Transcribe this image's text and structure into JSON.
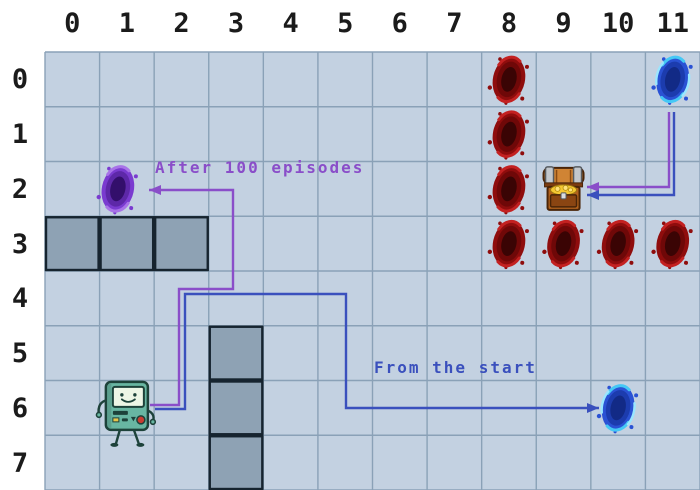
{
  "figure": {
    "type": "gridworld-diagram",
    "cols": 12,
    "rows": 8,
    "col_labels": [
      "0",
      "1",
      "2",
      "3",
      "4",
      "5",
      "6",
      "7",
      "8",
      "9",
      "10",
      "11"
    ],
    "row_labels": [
      "0",
      "1",
      "2",
      "3",
      "4",
      "5",
      "6",
      "7"
    ]
  },
  "colors": {
    "page_bg": "#ffffff",
    "cell_bg": "#c3d1e1",
    "grid_line": "#8aa1b7",
    "wall_fill": "#8ea2b4",
    "wall_border": "#16242f",
    "label_text": "#1b1b1b",
    "purple": "#8a4ec9",
    "blue": "#3a50bd"
  },
  "entities": {
    "walls": [
      {
        "col": 0,
        "row": 3
      },
      {
        "col": 1,
        "row": 3
      },
      {
        "col": 2,
        "row": 3
      },
      {
        "col": 3,
        "row": 5
      },
      {
        "col": 3,
        "row": 6
      },
      {
        "col": 3,
        "row": 7
      }
    ],
    "red_portals": [
      {
        "col": 8,
        "row": 0
      },
      {
        "col": 8,
        "row": 1
      },
      {
        "col": 8,
        "row": 2
      },
      {
        "col": 8,
        "row": 3
      },
      {
        "col": 9,
        "row": 3
      },
      {
        "col": 10,
        "row": 3
      },
      {
        "col": 11,
        "row": 3
      }
    ],
    "blue_portals": [
      {
        "col": 11,
        "row": 0
      },
      {
        "col": 10,
        "row": 6
      }
    ],
    "purple_portals": [
      {
        "col": 1,
        "row": 2
      }
    ],
    "treasure_chest": {
      "col": 9,
      "row": 2
    },
    "agent": {
      "col": 1,
      "row": 6,
      "character": "BMO"
    }
  },
  "annotations": [
    {
      "text": "After 100 episodes",
      "color": "#8a4ec9",
      "x": 155,
      "y": 160
    },
    {
      "text": "From the start",
      "color": "#3a50bd",
      "x": 374,
      "y": 360
    }
  ],
  "paths": [
    {
      "id": "purple-agent-to-purple-portal",
      "color": "#8a4ec9",
      "points": [
        [
          150,
          405
        ],
        [
          179,
          405
        ],
        [
          179,
          289
        ],
        [
          233,
          289
        ],
        [
          233,
          190
        ],
        [
          149,
          190
        ]
      ]
    },
    {
      "id": "blue-agent-to-blue-portal",
      "color": "#3a50bd",
      "points": [
        [
          155,
          409
        ],
        [
          185,
          409
        ],
        [
          185,
          294
        ],
        [
          346,
          294
        ],
        [
          346,
          408
        ],
        [
          599,
          408
        ]
      ]
    },
    {
      "id": "purple-blue-portal-to-chest",
      "color": "#8a4ec9",
      "points": [
        [
          669,
          112
        ],
        [
          669,
          187
        ],
        [
          587,
          187
        ]
      ]
    },
    {
      "id": "blue-blue-portal-to-chest",
      "color": "#3a50bd",
      "points": [
        [
          674,
          112
        ],
        [
          674,
          195
        ],
        [
          587,
          195
        ]
      ]
    }
  ]
}
